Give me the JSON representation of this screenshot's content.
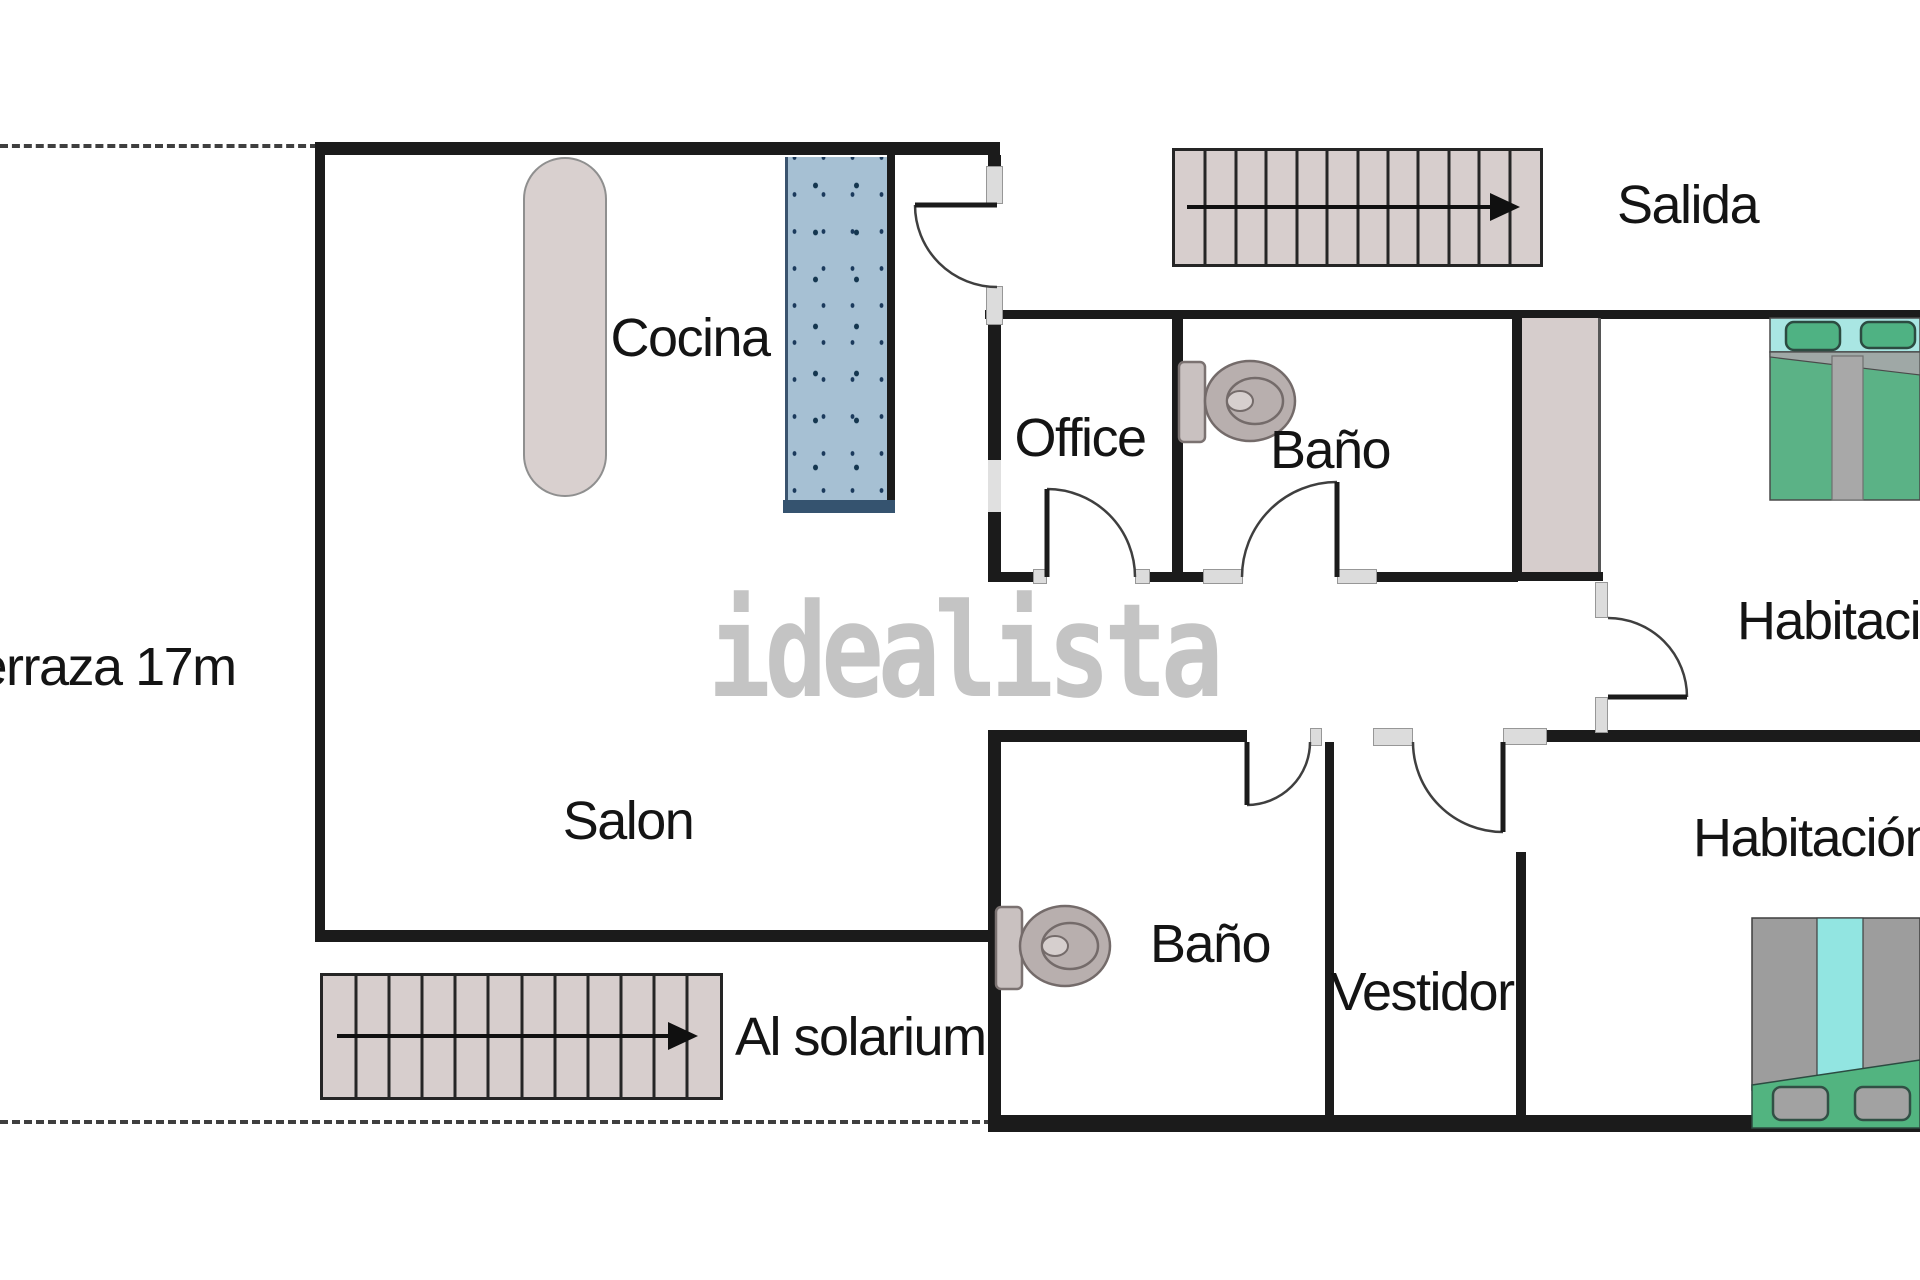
{
  "watermark": {
    "text": "idealista"
  },
  "labels": {
    "terraza": {
      "text": "Terraza 17m"
    },
    "cocina": {
      "text": "Cocina"
    },
    "office": {
      "text": "Office"
    },
    "bano_top": {
      "text": "Baño"
    },
    "salida": {
      "text": "Salida"
    },
    "habitacion_top": {
      "text": "Habitación"
    },
    "salon": {
      "text": "Salon"
    },
    "al_solarium": {
      "text": "Al solarium"
    },
    "bano_bottom": {
      "text": "Baño"
    },
    "vestidor": {
      "text": "Vestidor"
    },
    "habitacion_bottom": {
      "text": "Habitación"
    }
  },
  "stairs": {
    "top": {
      "steps": 12,
      "direction": "right",
      "leads_to": "Salida"
    },
    "bottom": {
      "steps": 12,
      "direction": "right",
      "leads_to": "Al solarium"
    }
  },
  "colors": {
    "wall": "#1b1b1b",
    "stairs_fill": "#d7cecd",
    "glass_partition": "#a6c0d3",
    "glass_dark": "#35536f",
    "kitchen_counter": "#d9d0cf",
    "wardrobe": "#d6cdcc",
    "bed_green": "#5bb286",
    "bed_cyan": "#a9e6e3",
    "bed_gray": "#9d9d9d",
    "toilet": "#b8afae",
    "watermark": "#c4c4c4",
    "text": "#141414"
  }
}
